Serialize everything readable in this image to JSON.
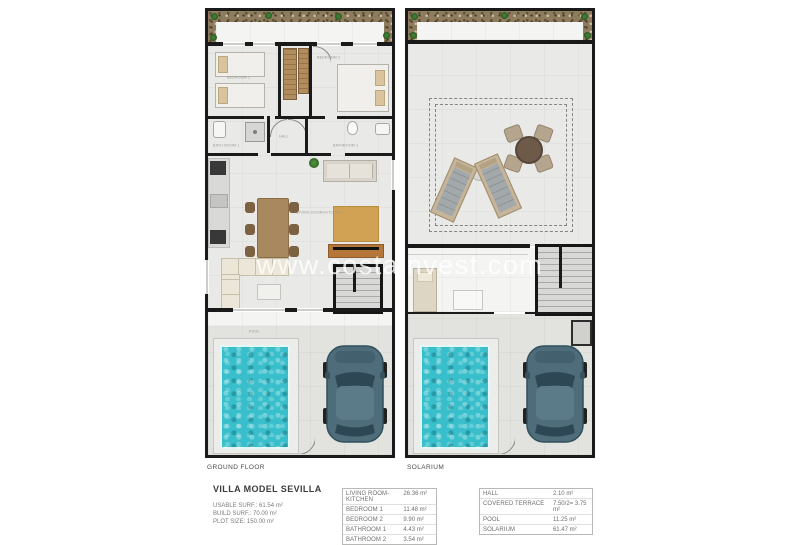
{
  "watermark": "www.costainvest.com",
  "plans": [
    {
      "label": "GROUND FLOOR",
      "rooms": {
        "bedroom1": "BEDROOM 1",
        "bedroom2": "BEDROOM 2",
        "bathroom1": "BATH ROOM 1",
        "bathroom2": "BATHROOM 1",
        "hall": "HALL",
        "living": "LIVING ROOM-KITCHEN",
        "pool": "POOL"
      }
    },
    {
      "label": "SOLARIUM"
    }
  ],
  "info": {
    "title": "VILLA MODEL SEVILLA",
    "lines": [
      "USABLE SURF.: 61.54 m²",
      "BUILD SURF.: 70.00 m²",
      "PLOT SIZE: 150.00 m²"
    ]
  },
  "tables": [
    {
      "rows": [
        {
          "name": "LIVING ROOM-KITCHEN",
          "value": "26.36 m²"
        },
        {
          "name": "BEDROOM 1",
          "value": "11.48 m²"
        },
        {
          "name": "BEDROOM 2",
          "value": "9.90 m²"
        },
        {
          "name": "BATHROOM 1",
          "value": "4.43 m²"
        },
        {
          "name": "BATHROOM 2",
          "value": "3.54 m²"
        }
      ]
    },
    {
      "rows": [
        {
          "name": "HALL",
          "value": "2.10 m²"
        },
        {
          "name": "COVERED TERRACE",
          "value": "7.50/2= 3.75 m²"
        },
        {
          "name": "POOL",
          "value": "11.25 m²"
        },
        {
          "name": "SOLARIUM",
          "value": "61.47 m²"
        }
      ]
    }
  ],
  "colors": {
    "wall": "#1a1a1a",
    "pool_water": "#38bfcb",
    "wood": "#b08c5e",
    "car_body": "#4e6c7a",
    "rug": "#d1a253"
  }
}
